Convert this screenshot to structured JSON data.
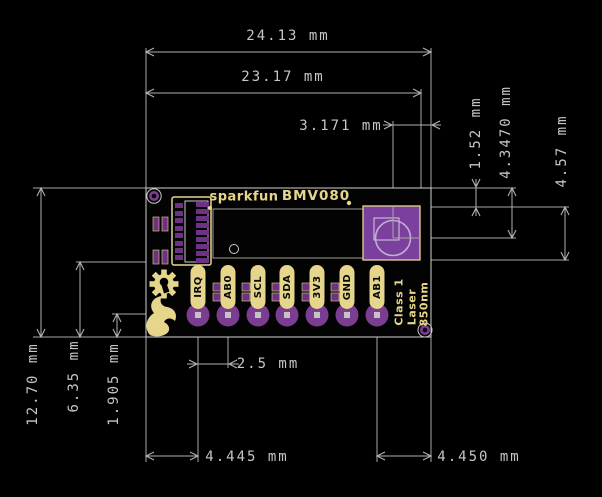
{
  "board": {
    "brand": "sparkfun",
    "model": "BMV080",
    "laser_marking": {
      "line1": "Class 1",
      "line2": "Laser",
      "line3": "850nm"
    },
    "pins": [
      "IRQ",
      "AB0",
      "SCL",
      "SDA",
      "3V3",
      "GND",
      "AB1"
    ]
  },
  "dims": {
    "overall_width": "24.13 mm",
    "inner_width": "23.17 mm",
    "laser_from_right_edge": "3.171 mm",
    "sensor_top_offset": "1.52 mm",
    "laser_center_offset": "4.3470 mm",
    "sensor_height": "4.57 mm",
    "board_height": "12.70 mm",
    "connector_centerline": "6.35 mm",
    "pin_row_offset": "1.905 mm",
    "pin_pitch": "2.5 mm",
    "left_edge_to_first_pin": "4.445 mm",
    "last_pin_to_right_edge": "4.450 mm"
  },
  "colors": {
    "background": "#000000",
    "dimension_lines": "#b2b2b2",
    "dimension_text": "#c6c6c6",
    "silkscreen_yellow": "#e6d68c",
    "pad_purple": "#7a3d92",
    "connector_pad_purple": "#6e3285",
    "sensor_purple": "#7b3f9d",
    "board_outline": "#d2d2d2"
  }
}
